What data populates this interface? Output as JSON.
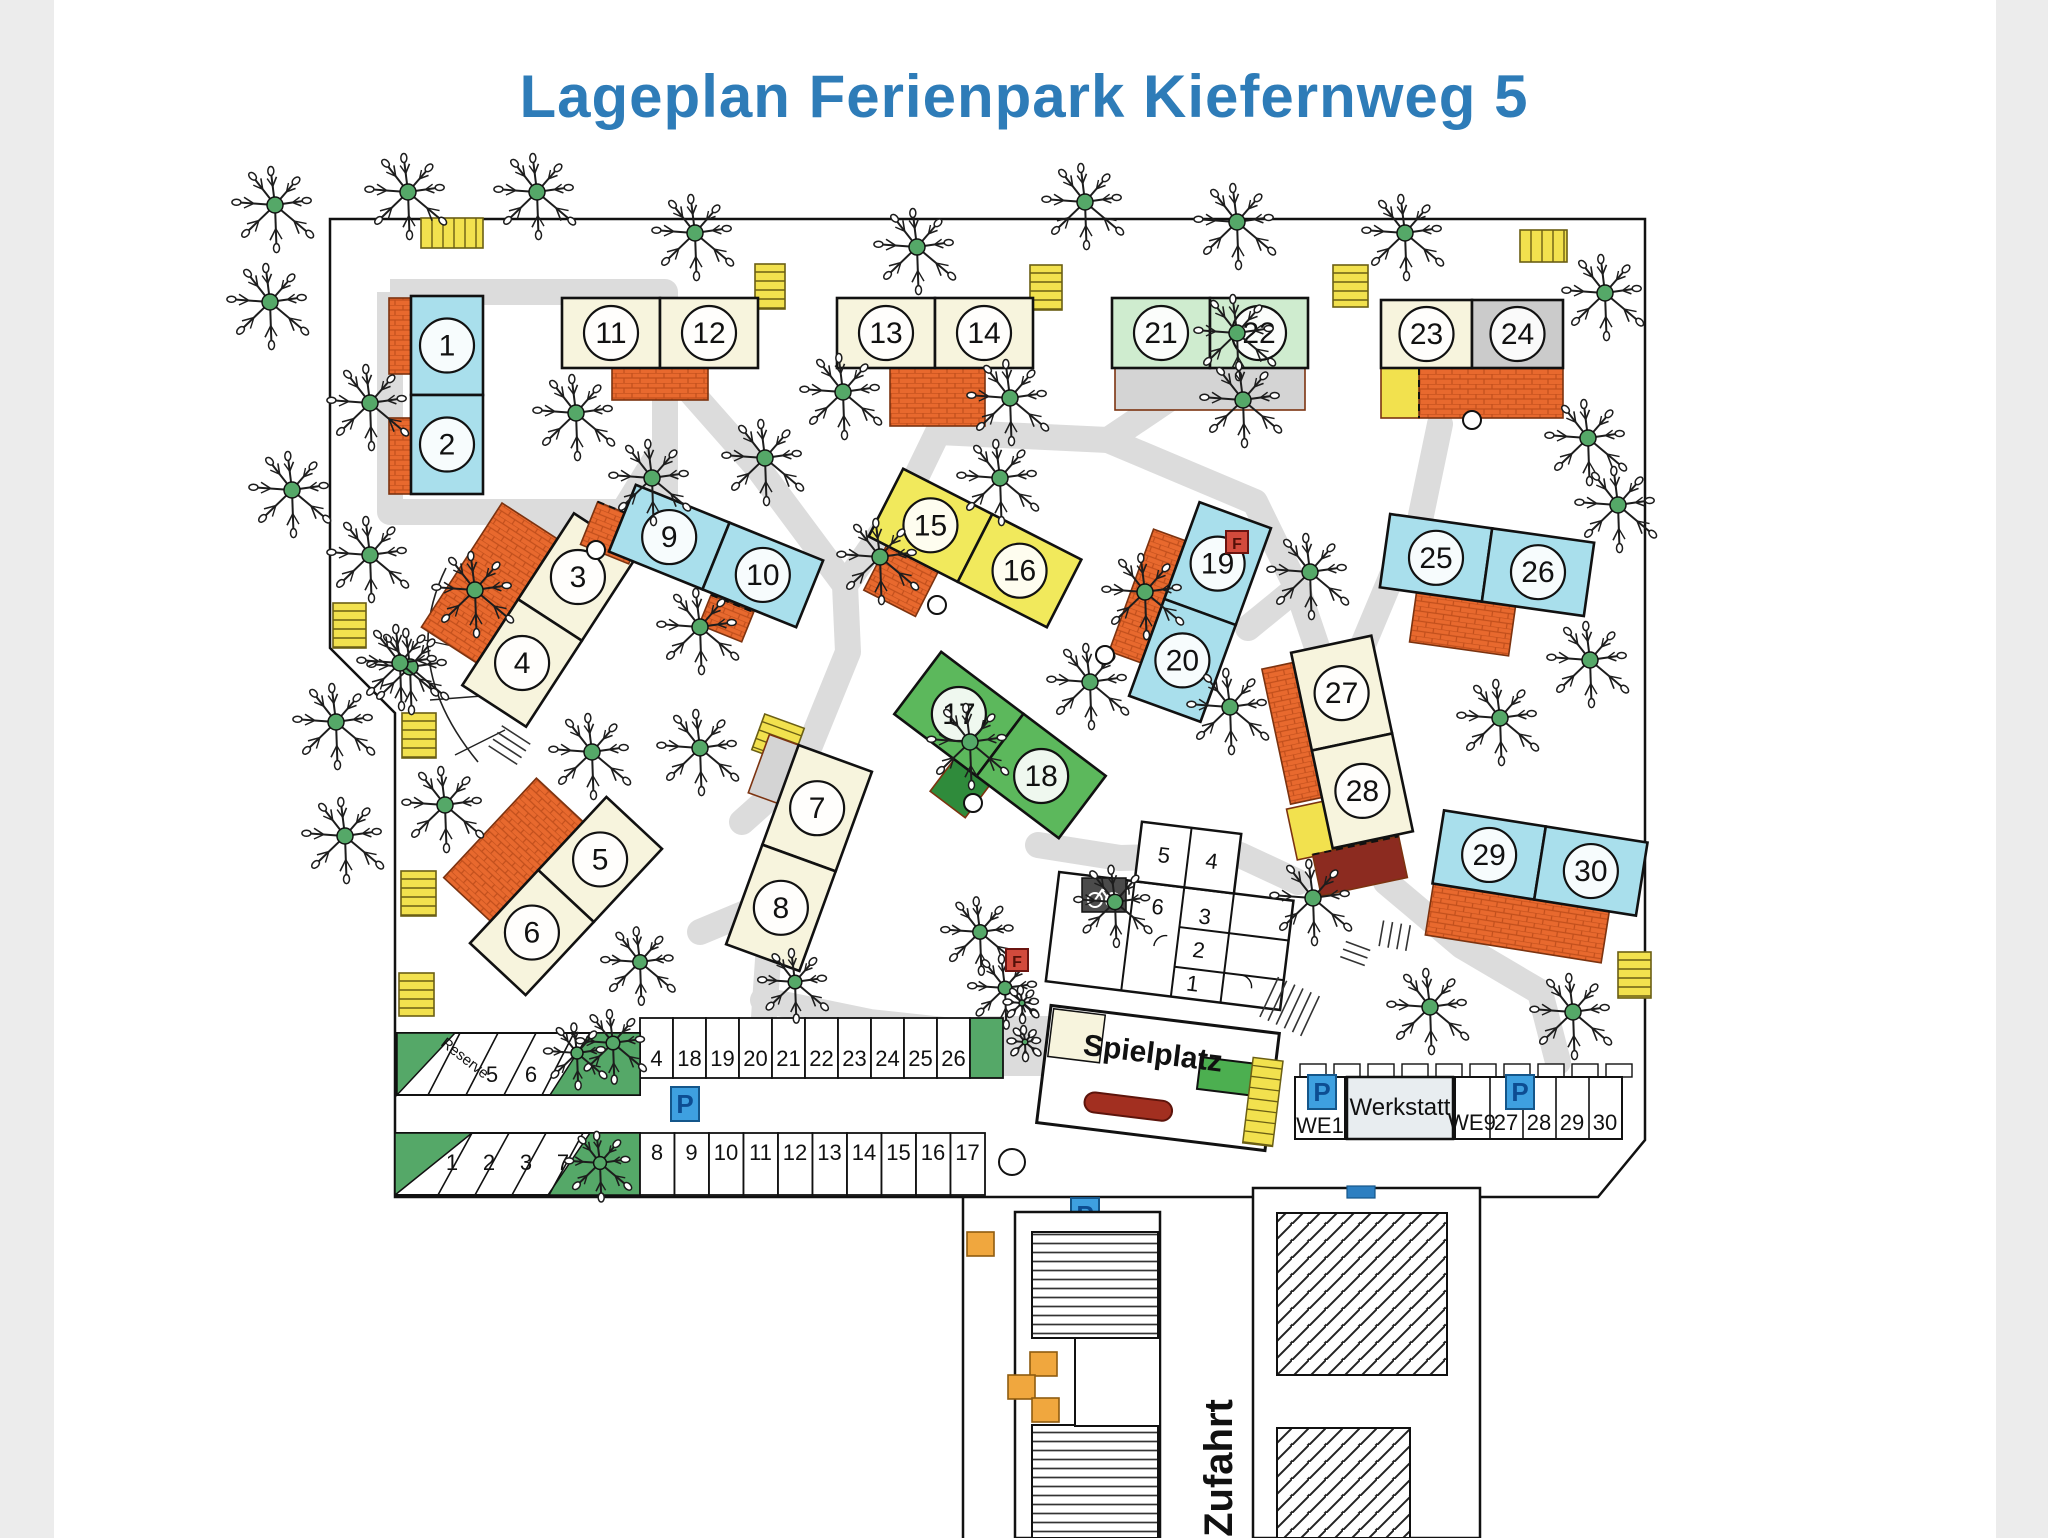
{
  "title": {
    "text": "Lageplan Ferienpark Kiefernweg  5"
  },
  "colors": {
    "title_blue": "#2e7cb8",
    "cyan": "#a9dfec",
    "cream": "#f7f4dd",
    "yellow": "#f1e95c",
    "lightgreen": "#cfeccf",
    "green": "#5cb85c",
    "gray": "#cbcbcb",
    "orange": "#e8692e",
    "carport_yellow": "#f2e14e",
    "path_gray": "#dcdcdc",
    "terrace_gray": "#d4d4d4",
    "dark_green": "#2f8b3b",
    "dark_red": "#8c2b20",
    "p_blue": "#3ea0e0",
    "p_letter": "#0d4d92",
    "f_red": "#d24a3c",
    "tree_green": "#55a868",
    "bench_red": "#a22f20",
    "playground_green": "#4caf50",
    "werkstatt_fill": "#e8edf0"
  },
  "signs": {
    "parking": "P",
    "hydrant": "F"
  },
  "road_label": "Zufahrt",
  "spielplatz": {
    "label": "Spielplatz"
  },
  "sanitary_building": {
    "rooms": [
      "5",
      "4",
      "6",
      "3",
      "2",
      "1"
    ]
  },
  "parking": {
    "upper_diagonal_row": {
      "stalls": [
        "Reserve",
        "5",
        "6"
      ]
    },
    "upper_straight_row": {
      "stalls": [
        "4",
        "18",
        "19",
        "20",
        "21",
        "22",
        "23",
        "24",
        "25",
        "26"
      ]
    },
    "lower_diagonal_row": {
      "stalls": [
        "1",
        "2",
        "3",
        "7"
      ]
    },
    "lower_straight_row": {
      "stalls": [
        "8",
        "9",
        "10",
        "11",
        "12",
        "13",
        "14",
        "15",
        "16",
        "17"
      ]
    },
    "right_area": {
      "stalls": [
        "WE1",
        "WE9",
        "27",
        "28",
        "29",
        "30"
      ],
      "werkstatt": "Werkstatt"
    }
  },
  "boundary_path": "M330,219 L1645,219 L1645,1140 L1598,1197 L395,1197 L395,713 L330,648 Z",
  "buildings": [
    {
      "id": "1-2",
      "units": [
        "1",
        "2"
      ],
      "color": "cyan",
      "cx": 447,
      "cy": 395,
      "w": 72,
      "h": 198,
      "rot": 0,
      "split": "h",
      "terraces": [
        {
          "x": -58,
          "y": -97,
          "w": 22,
          "h": 76
        },
        {
          "x": -58,
          "y": 23,
          "w": 22,
          "h": 76
        }
      ]
    },
    {
      "id": "3-4",
      "units": [
        "3",
        "4"
      ],
      "color": "cream",
      "cx": 550,
      "cy": 620,
      "w": 76,
      "h": 205,
      "rot": 33,
      "split": "h",
      "terraces": [
        {
          "x": -104,
          "y": -72,
          "w": 66,
          "h": 148
        }
      ]
    },
    {
      "id": "5-6",
      "units": [
        "5",
        "6"
      ],
      "color": "cream",
      "cx": 566,
      "cy": 896,
      "w": 76,
      "h": 200,
      "rot": 43,
      "split": "h",
      "terraces": [
        {
          "x": -102,
          "y": -66,
          "w": 64,
          "h": 136
        }
      ]
    },
    {
      "id": "7-8",
      "units": [
        "7",
        "8"
      ],
      "color": "cream",
      "cx": 799,
      "cy": 858,
      "w": 78,
      "h": 212,
      "rot": 20,
      "split": "h",
      "terraces": [
        {
          "x": -70,
          "y": -106,
          "w": 32,
          "h": 62,
          "fill": "gray"
        }
      ]
    },
    {
      "id": "9-10",
      "units": [
        "9",
        "10"
      ],
      "color": "cyan",
      "cx": 716,
      "cy": 556,
      "w": 202,
      "h": 72,
      "rot": 22,
      "split": "v",
      "terraces": [
        {
          "x": -130,
          "y": -6,
          "w": 52,
          "h": 46
        },
        {
          "x": 10,
          "y": 38,
          "w": 46,
          "h": 32
        }
      ]
    },
    {
      "id": "11-12",
      "units": [
        "11",
        "12"
      ],
      "color": "cream",
      "cx": 660,
      "cy": 333,
      "w": 196,
      "h": 70,
      "rot": 0,
      "split": "v",
      "terraces": [
        {
          "x": -48,
          "y": 35,
          "w": 96,
          "h": 32
        }
      ]
    },
    {
      "id": "13-14",
      "units": [
        "13",
        "14"
      ],
      "color": "cream",
      "cx": 935,
      "cy": 333,
      "w": 196,
      "h": 70,
      "rot": 0,
      "split": "v",
      "terraces": [
        {
          "x": -45,
          "y": 35,
          "w": 95,
          "h": 58
        }
      ]
    },
    {
      "id": "15-16",
      "units": [
        "15",
        "16"
      ],
      "color": "yellow",
      "cx": 975,
      "cy": 548,
      "w": 200,
      "h": 76,
      "rot": 27,
      "split": "v",
      "terraces": [
        {
          "x": -80,
          "y": 32,
          "w": 58,
          "h": 56
        }
      ]
    },
    {
      "id": "17-18",
      "units": [
        "17",
        "18"
      ],
      "color": "green",
      "cx": 1000,
      "cy": 745,
      "w": 206,
      "h": 78,
      "rot": 37,
      "split": "v",
      "terraces": [
        {
          "x": -28,
          "y": 39,
          "w": 44,
          "h": 40,
          "fill": "dkgreen"
        }
      ]
    },
    {
      "id": "19-20",
      "units": [
        "19",
        "20"
      ],
      "color": "cyan",
      "cx": 1200,
      "cy": 612,
      "w": 76,
      "h": 206,
      "rot": 20,
      "split": "h",
      "terraces": [
        {
          "x": -72,
          "y": -62,
          "w": 34,
          "h": 130
        }
      ]
    },
    {
      "id": "21-22",
      "units": [
        "21",
        "22"
      ],
      "color": "lightgreen",
      "cx": 1210,
      "cy": 333,
      "w": 196,
      "h": 70,
      "rot": 0,
      "split": "v",
      "terraces": [
        {
          "x": -95,
          "y": 35,
          "w": 190,
          "h": 42,
          "fill": "gray",
          "dash": true
        }
      ]
    },
    {
      "id": "23-24",
      "units": [
        "23",
        "24"
      ],
      "color": [
        "cream",
        "gray"
      ],
      "cx": 1472,
      "cy": 334,
      "w": 182,
      "h": 68,
      "rot": 0,
      "split": "v",
      "terraces": [
        {
          "x": -53,
          "y": 34,
          "w": 144,
          "h": 50
        },
        {
          "x": -91,
          "y": 34,
          "w": 38,
          "h": 50,
          "fill": "carport"
        }
      ]
    },
    {
      "id": "25-26",
      "units": [
        "25",
        "26"
      ],
      "color": "cyan",
      "cx": 1487,
      "cy": 565,
      "w": 206,
      "h": 74,
      "rot": 8,
      "split": "v",
      "terraces": [
        {
          "x": -66,
          "y": 37,
          "w": 100,
          "h": 50
        }
      ]
    },
    {
      "id": "27-28",
      "units": [
        "27",
        "28"
      ],
      "color": "cream",
      "cx": 1352,
      "cy": 742,
      "w": 82,
      "h": 200,
      "rot": -12,
      "split": "h",
      "terraces": [
        {
          "x": -73,
          "y": -90,
          "w": 32,
          "h": 138
        },
        {
          "x": -78,
          "y": 52,
          "w": 42,
          "h": 52,
          "fill": "carport"
        },
        {
          "x": -62,
          "y": 102,
          "w": 88,
          "h": 42,
          "fill": "dkred"
        }
      ]
    },
    {
      "id": "29-30",
      "units": [
        "29",
        "30"
      ],
      "color": "cyan",
      "cx": 1540,
      "cy": 863,
      "w": 206,
      "h": 74,
      "rot": 9,
      "split": "v",
      "terraces": [
        {
          "x": -102,
          "y": 37,
          "w": 178,
          "h": 52
        }
      ]
    }
  ],
  "carports": [
    [
      421,
      218,
      62,
      30,
      "v",
      0
    ],
    [
      755,
      264,
      30,
      45,
      "h",
      0
    ],
    [
      1030,
      265,
      32,
      45,
      "h",
      0
    ],
    [
      1520,
      230,
      47,
      32,
      "v",
      0
    ],
    [
      1333,
      265,
      35,
      42,
      "h",
      0
    ],
    [
      333,
      603,
      33,
      45,
      "h",
      0
    ],
    [
      402,
      713,
      34,
      45,
      "h",
      0
    ],
    [
      401,
      871,
      35,
      45,
      "h",
      0
    ],
    [
      399,
      973,
      35,
      43,
      "h",
      0
    ],
    [
      757,
      720,
      42,
      38,
      "h",
      20
    ],
    [
      1618,
      952,
      33,
      46,
      "h",
      0
    ],
    [
      1332,
      838,
      30,
      22,
      "v",
      -12
    ]
  ],
  "trees": [
    [
      275,
      205
    ],
    [
      408,
      192
    ],
    [
      537,
      192
    ],
    [
      695,
      233
    ],
    [
      917,
      247
    ],
    [
      1085,
      202
    ],
    [
      1237,
      222
    ],
    [
      1405,
      233
    ],
    [
      1605,
      293
    ],
    [
      270,
      302
    ],
    [
      370,
      403
    ],
    [
      576,
      413
    ],
    [
      843,
      392
    ],
    [
      1010,
      398
    ],
    [
      765,
      458
    ],
    [
      652,
      478
    ],
    [
      1237,
      333
    ],
    [
      1243,
      400
    ],
    [
      1588,
      438
    ],
    [
      1618,
      505
    ],
    [
      292,
      490
    ],
    [
      370,
      555
    ],
    [
      475,
      590
    ],
    [
      410,
      667
    ],
    [
      400,
      663
    ],
    [
      700,
      627
    ],
    [
      880,
      557
    ],
    [
      1000,
      478
    ],
    [
      1145,
      592
    ],
    [
      1310,
      572
    ],
    [
      1590,
      660
    ],
    [
      1500,
      718
    ],
    [
      336,
      722
    ],
    [
      445,
      805
    ],
    [
      345,
      836
    ],
    [
      592,
      752
    ],
    [
      700,
      748
    ],
    [
      970,
      742
    ],
    [
      1090,
      682
    ],
    [
      1230,
      707
    ],
    [
      1313,
      898
    ],
    [
      1430,
      1007
    ],
    [
      1573,
      1012
    ],
    [
      613,
      1043,
      34
    ],
    [
      577,
      1053,
      30
    ],
    [
      600,
      1163,
      32
    ],
    [
      640,
      962,
      36
    ],
    [
      795,
      982,
      34
    ],
    [
      980,
      932,
      36
    ],
    [
      1005,
      988,
      34
    ],
    [
      1115,
      902,
      38
    ],
    [
      1022,
      1003,
      15
    ],
    [
      1025,
      1042,
      14
    ]
  ],
  "paths": [
    [
      [
        652,
        348
      ],
      [
        758,
        468
      ],
      [
        845,
        585
      ],
      [
        848,
        652
      ],
      [
        800,
        770
      ],
      [
        772,
        902
      ],
      [
        763,
        1032
      ]
    ],
    [
      [
        845,
        585
      ],
      [
        906,
        498
      ],
      [
        938,
        432
      ]
    ],
    [
      [
        938,
        432
      ],
      [
        1108,
        440
      ]
    ],
    [
      [
        1108,
        440
      ],
      [
        1200,
        378
      ]
    ],
    [
      [
        1108,
        440
      ],
      [
        1255,
        502
      ],
      [
        1297,
        588
      ],
      [
        1322,
        662
      ],
      [
        1338,
        700
      ]
    ],
    [
      [
        1297,
        588
      ],
      [
        1248,
        628
      ]
    ],
    [
      [
        1440,
        424
      ],
      [
        1420,
        520
      ],
      [
        1396,
        566
      ],
      [
        1360,
        652
      ],
      [
        1346,
        772
      ],
      [
        1386,
        882
      ],
      [
        1462,
        946
      ],
      [
        1540,
        992
      ],
      [
        1558,
        1062
      ]
    ],
    [
      [
        660,
        452
      ],
      [
        612,
        530
      ]
    ],
    [
      [
        560,
        514
      ],
      [
        520,
        572
      ]
    ],
    [
      [
        800,
        770
      ],
      [
        742,
        822
      ]
    ],
    [
      [
        772,
        902
      ],
      [
        700,
        932
      ]
    ],
    [
      [
        763,
        1000
      ],
      [
        870,
        1022
      ],
      [
        962,
        1032
      ]
    ],
    [
      [
        1038,
        845
      ],
      [
        1120,
        858
      ],
      [
        1240,
        855
      ],
      [
        1298,
        882
      ]
    ]
  ],
  "path_ring": [
    [
      390,
      292
    ],
    [
      665,
      292
    ],
    [
      665,
      512
    ],
    [
      390,
      512
    ],
    [
      390,
      292
    ]
  ],
  "circles": [
    [
      596,
      550,
      9
    ],
    [
      937,
      605,
      9
    ],
    [
      973,
      803,
      9
    ],
    [
      1105,
      655,
      9
    ],
    [
      1472,
      420,
      9
    ],
    [
      1012,
      1162,
      13
    ]
  ],
  "f_signs": [
    [
      1237,
      542
    ],
    [
      1017,
      960
    ]
  ],
  "p_signs_site": [
    [
      685,
      1104
    ],
    [
      1322,
      1092
    ],
    [
      1520,
      1092
    ],
    [
      1085,
      1215
    ],
    [
      1120,
      1373
    ]
  ],
  "orange_squares": [
    [
      967,
      1232
    ],
    [
      1030,
      1352
    ],
    [
      1008,
      1375
    ],
    [
      1032,
      1398
    ]
  ]
}
